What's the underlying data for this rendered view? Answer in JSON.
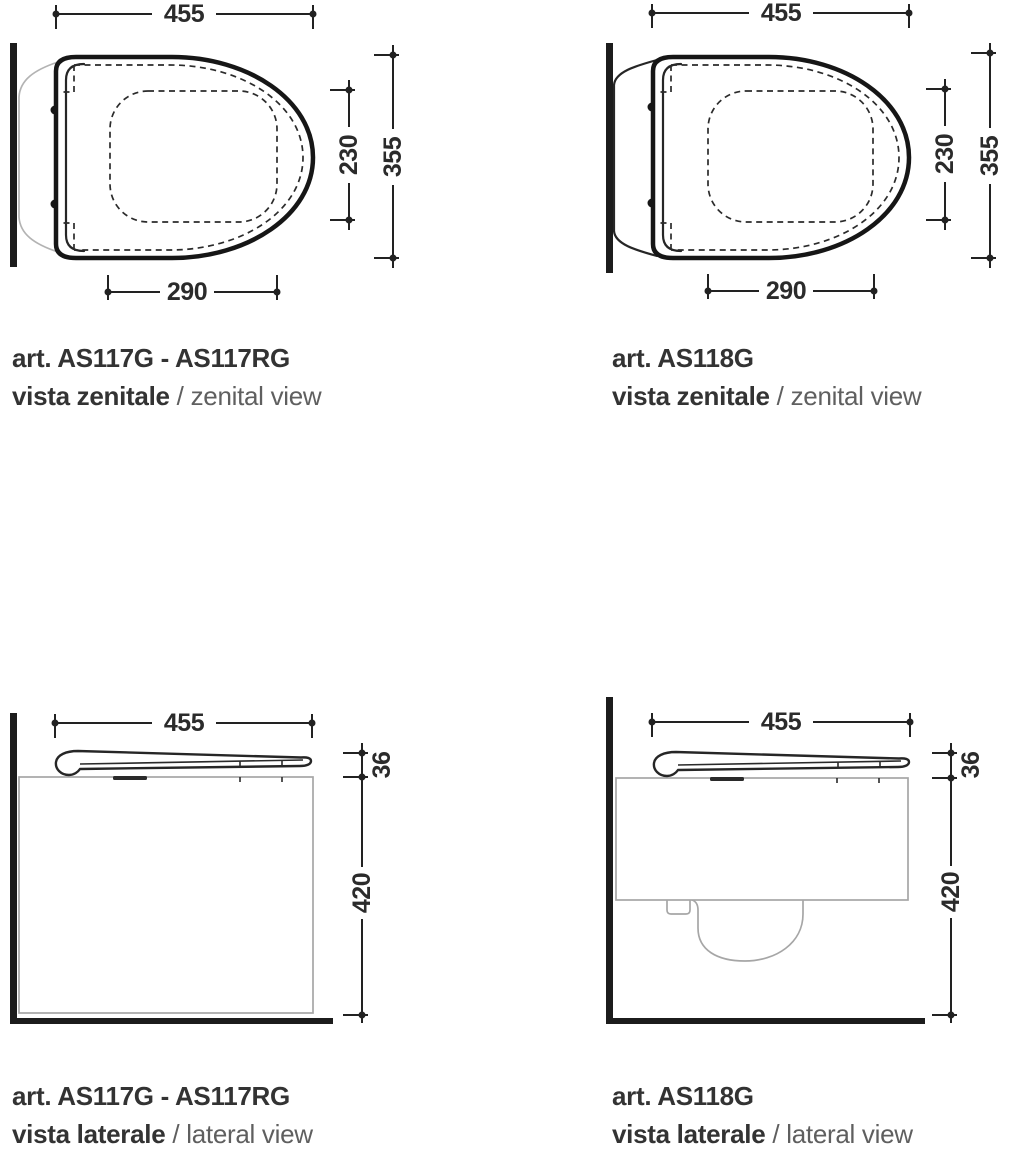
{
  "figures": [
    {
      "article": "art. AS117G - AS117RG",
      "view_primary": "vista zenitale",
      "separator": "/",
      "view_secondary": "zenital view",
      "dimensions": {
        "overall_width": "455",
        "seat_inner_depth": "230",
        "overall_depth": "355",
        "front_width": "290"
      }
    },
    {
      "article": "art. AS118G",
      "view_primary": "vista zenitale",
      "separator": "/",
      "view_secondary": "zenital view",
      "dimensions": {
        "overall_width": "455",
        "seat_inner_depth": "230",
        "overall_depth": "355",
        "front_width": "290"
      }
    },
    {
      "article": "art. AS117G - AS117RG",
      "view_primary": "vista laterale",
      "separator": "/",
      "view_secondary": "lateral view",
      "dimensions": {
        "overall_width": "455",
        "seat_thickness": "36",
        "bowl_height": "420"
      }
    },
    {
      "article": "art. AS118G",
      "view_primary": "vista laterale",
      "separator": "/",
      "view_secondary": "lateral view",
      "dimensions": {
        "overall_width": "455",
        "seat_thickness": "36",
        "bowl_height": "420"
      }
    }
  ],
  "colors": {
    "line": "#222222",
    "text_primary": "#333333",
    "text_secondary": "#5f5f5f",
    "light_outline": "#b3b3b3",
    "wall": "#1c1c1c",
    "background": "#ffffff"
  }
}
